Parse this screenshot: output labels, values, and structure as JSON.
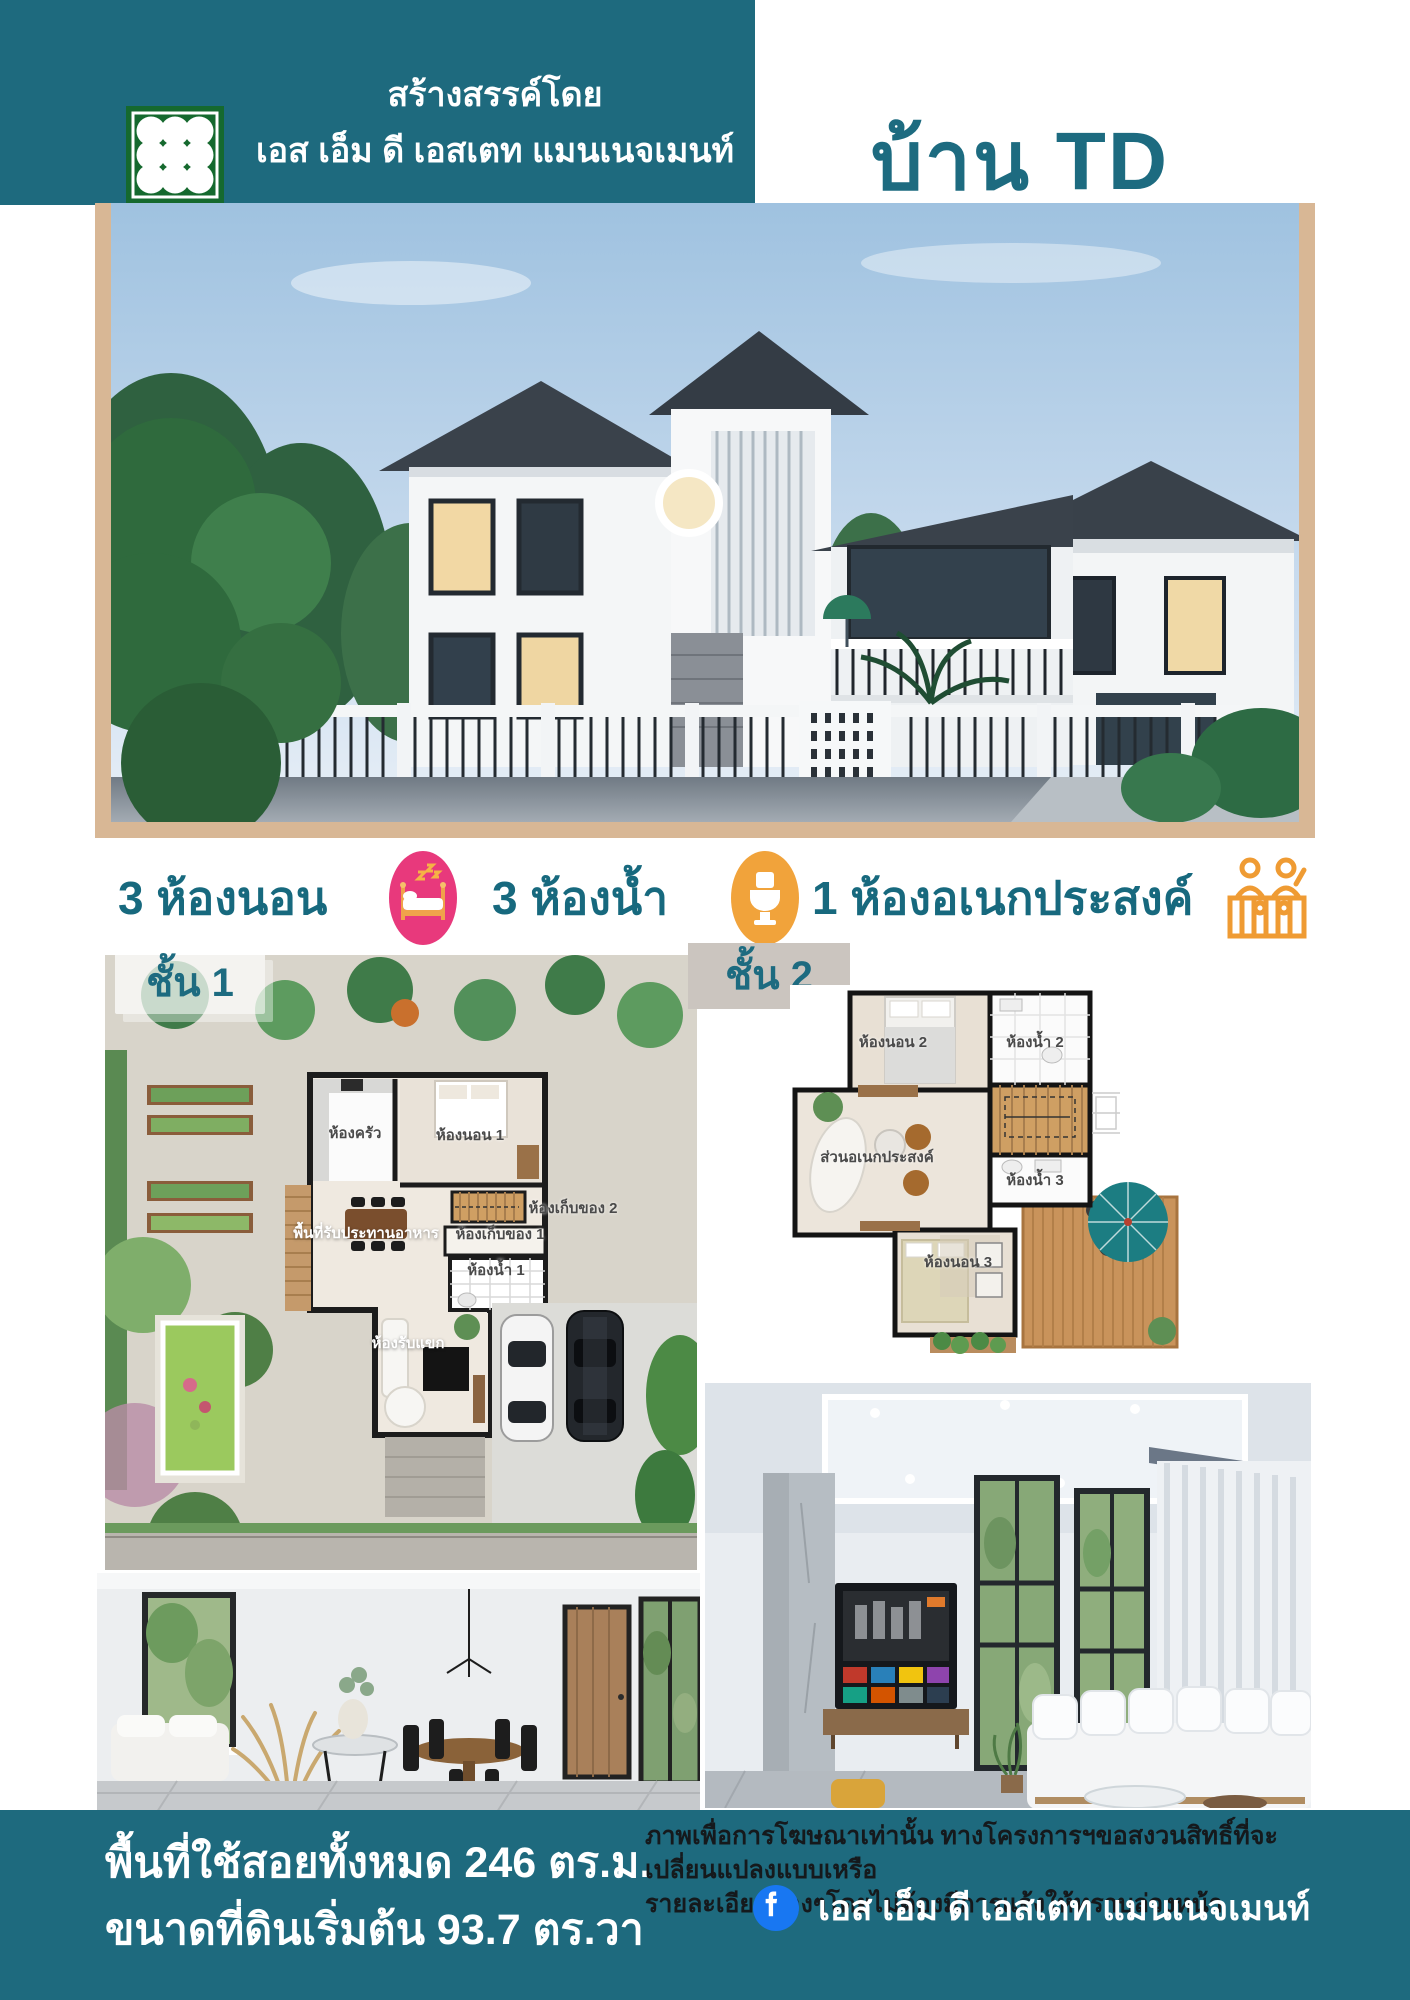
{
  "colors": {
    "teal": "#1e6a7e",
    "title_teal": "#1d6b80",
    "tan": "#d8b795",
    "pink": "#e8397c",
    "orange": "#f1a33b",
    "family_orange": "#ef9b33",
    "logo_green": "#15692e",
    "facebook_blue": "#1877f2",
    "chip2_bg": "#cbc5bf"
  },
  "header": {
    "created_by": "สร้างสรรค์โดย",
    "company": "เอส เอ็ม ดี เอสเตท แมนเนจเมนท์",
    "title": "บ้าน TD",
    "logo_icon": "smd-grid-logo"
  },
  "features": {
    "bedrooms": {
      "label": "3 ห้องนอน",
      "icon": "bed-icon"
    },
    "bathrooms": {
      "label": "3 ห้องน้ำ",
      "icon": "toilet-icon"
    },
    "multipurpose": {
      "label": "1 ห้องอเนกประสงค์",
      "icon": "family-icon"
    }
  },
  "floors": {
    "floor1": {
      "label": "ชั้น 1",
      "rooms": [
        {
          "label": "ห้องครัว"
        },
        {
          "label": "ห้องนอน 1"
        },
        {
          "label": "พื้นที่รับประทานอาหาร"
        },
        {
          "label": "ห้องเก็บของ 2"
        },
        {
          "label": "ห้องเก็บของ 1"
        },
        {
          "label": "ห้องน้ำ 1"
        },
        {
          "label": "ห้องรับแขก"
        }
      ]
    },
    "floor2": {
      "label": "ชั้น 2",
      "rooms": [
        {
          "label": "ห้องนอน 2"
        },
        {
          "label": "ห้องน้ำ 2"
        },
        {
          "label": "ส่วนอเนกประสงค์"
        },
        {
          "label": "ห้องน้ำ 3"
        },
        {
          "label": "ห้องนอน 3"
        }
      ]
    }
  },
  "footer": {
    "area_line1": "พื้นที่ใช้สอยทั้งหมด 246 ตร.ม.",
    "area_line2": "ขนาดที่ดินเริ่มต้น 93.7 ตร.วา",
    "disclaimer_line1": "ภาพเพื่อการโฆษณาเท่านั้น ทางโครงการฯขอสงวนสิทธิ์ที่จะเปลี่ยนแปลงแบบเหรือ",
    "disclaimer_line2": "รายละเอียดต่างๆโดยไม่ต้องมีการแจ้งให้ทราบล่วงหน้า",
    "facebook_page": "เอส เอ็ม ดี เอสเตท แมนเนจเมนท์",
    "facebook_icon": "facebook-icon"
  }
}
